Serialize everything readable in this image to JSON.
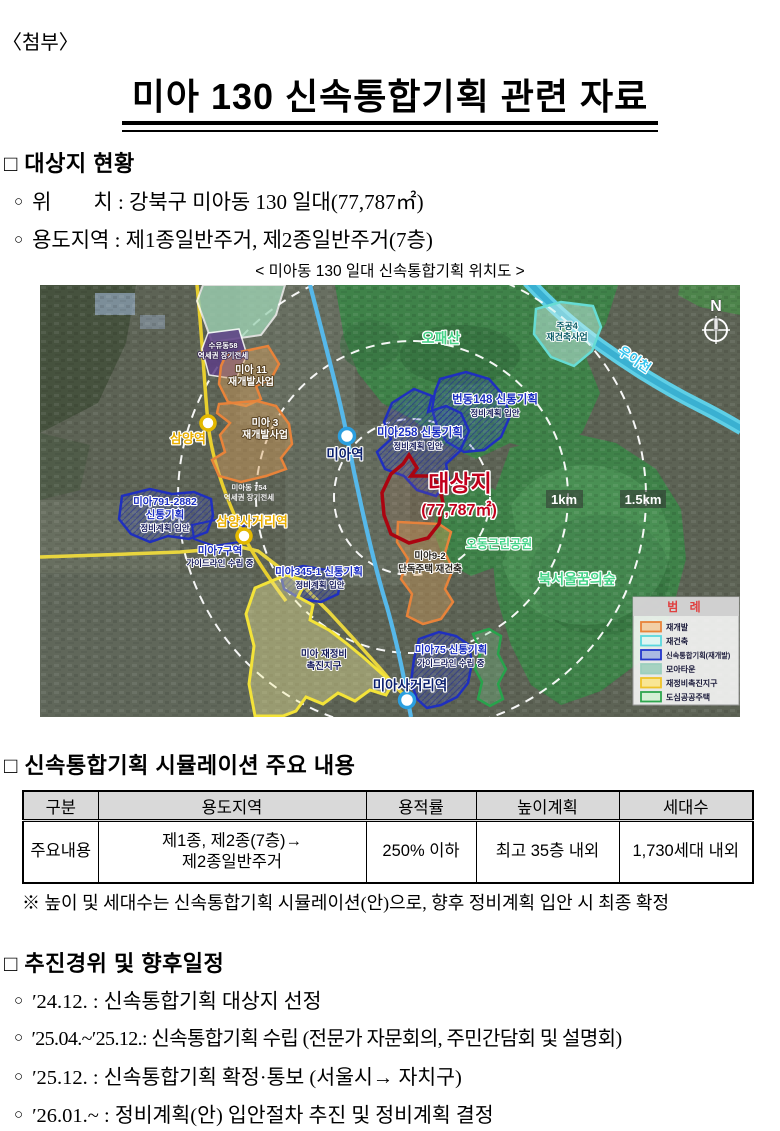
{
  "page": {
    "attachment_label": "〈첨부〉",
    "title": "미아 130 신속통합기획 관련 자료"
  },
  "site": {
    "heading": "□ 대상지 현황",
    "bullet": "○",
    "items": [
      "위　　치 : 강북구 미아동 130 일대(77,787㎡)",
      "용도지역 : 제1종일반주거, 제2종일반주거(7층)"
    ]
  },
  "map": {
    "caption": "< 미아동 130 일대 신속통합기획 위치도 >",
    "compass": "N",
    "river": "우이천",
    "rings": {
      "r1": "1km",
      "r2": "1.5km"
    },
    "parks": [
      "오패산",
      "오동근린공원",
      "북서울꿈의숲"
    ],
    "stations": [
      "삼양역",
      "미아역",
      "삼양사거리역",
      "미아사거리역"
    ],
    "target": {
      "name": "대상지",
      "area": "(77,787㎡)"
    },
    "zones": [
      {
        "l1": "수유동58",
        "l2": "역세권 장기전세"
      },
      {
        "l1": "미아 11",
        "l2": "재개발사업"
      },
      {
        "l1": "미아 3",
        "l2": "재개발사업"
      },
      {
        "l1": "번동148 신통기획",
        "l2": "정비계획 입안"
      },
      {
        "l1": "미아258 신통기획",
        "l2": "정비계획 입안"
      },
      {
        "l1": "주공4",
        "l2": "재건축사업"
      },
      {
        "l1": "미아791-2882",
        "l2": "신통기획",
        "l3": "정비계획 입안"
      },
      {
        "l1": "미아7구역",
        "l2": "가이드라인 수립 중"
      },
      {
        "l1": "미아동 754",
        "l2": "역세권 장기전세"
      },
      {
        "l1": "미아345-1 신통기획",
        "l2": "정비계획 입안"
      },
      {
        "l1": "미아 재정비",
        "l2": "촉진지구"
      },
      {
        "l1": "미아9-2",
        "l2": "단독주택 재건축"
      },
      {
        "l1": "미아75 신통기획",
        "l2": "가이드라인 수립 중"
      }
    ],
    "legend": {
      "title": "범 례",
      "items": [
        {
          "label": "재개발",
          "stroke": "#e8833a",
          "fill": "#f2cfa6"
        },
        {
          "label": "재건축",
          "stroke": "#5ad8de",
          "fill": "#dff6f2"
        },
        {
          "label": "신속통합기획(재개발)",
          "stroke": "#2336cc",
          "fill": "#aab9e2"
        },
        {
          "label": "모아타운",
          "stroke": "#9ccfbe",
          "fill": "#a6d2c1"
        },
        {
          "label": "재정비촉진지구",
          "stroke": "#eec32a",
          "fill": "#f9e694"
        },
        {
          "label": "도심공공주택",
          "stroke": "#2ea64e",
          "fill": "#d5f0d5"
        }
      ]
    }
  },
  "simulation": {
    "heading": "□ 신속통합기획 시뮬레이션 주요 내용",
    "table": {
      "headers": [
        "구분",
        "용도지역",
        "용적률",
        "높이계획",
        "세대수"
      ],
      "row": {
        "label": "주요내용",
        "usage1": "제1종, 제2종(7층)→",
        "usage2": "제2종일반주거",
        "far": "250% 이하",
        "height": "최고 35층 내외",
        "households": "1,730세대 내외"
      }
    },
    "note": "※ 높이 및 세대수는 신속통합기획 시뮬레이션(안)으로, 향후 정비계획 입안 시 최종 확정"
  },
  "schedule": {
    "heading": "□ 추진경위 및 향후일정",
    "bullet": "○",
    "items": [
      "′24.12. : 신속통합기획 대상지 선정",
      "′25.04.~′25.12.: 신속통합기획 수립 (전문가 자문회의, 주민간담회 및 설명회)",
      "′25.12. : 신속통합기획 확정·통보 (서울시→ 자치구)",
      "′26.01.~ : 정비계획(안) 입안절차 추진 및 정비계획 결정"
    ]
  }
}
